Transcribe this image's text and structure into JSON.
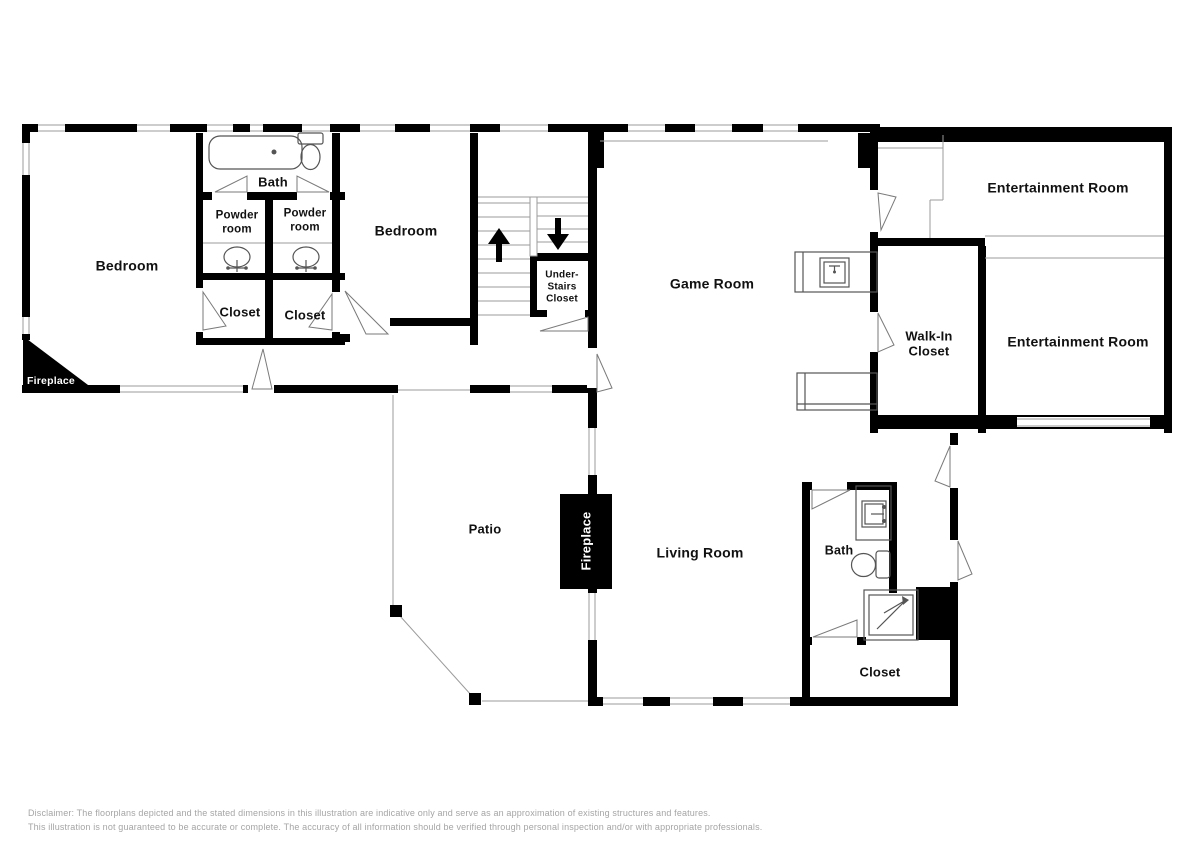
{
  "labels": {
    "bedroom_left": "Bedroom",
    "bath_upper": "Bath",
    "powder_room_left": "Powder room",
    "powder_room_right": "Powder room",
    "bedroom_middle": "Bedroom",
    "closet_left": "Closet",
    "closet_right": "Closet",
    "under_stairs_closet": "Under-Stairs Closet",
    "game_room": "Game Room",
    "walk_in_closet": "Walk-In Closet",
    "entertainment_room_upper": "Entertainment Room",
    "entertainment_room_lower": "Entertainment Room",
    "fireplace_corner": "Fireplace",
    "patio": "Patio",
    "fireplace_living": "Fireplace",
    "living_room": "Living Room",
    "bath_lower": "Bath",
    "closet_lower": "Closet"
  },
  "disclaimer": {
    "line1": "Disclaimer: The floorplans depicted and the stated dimensions in this illustration are indicative only and serve as an approximation of existing structures and features.",
    "line2": "This illustration is not guaranteed to be accurate or complete. The accuracy of all information should be verified through personal inspection and/or with appropriate professionals."
  },
  "colors": {
    "wall": "#000000",
    "fixture_line": "#555555",
    "thin_line": "#9b9b9b",
    "disclaimer_text": "#a5a5a5"
  }
}
